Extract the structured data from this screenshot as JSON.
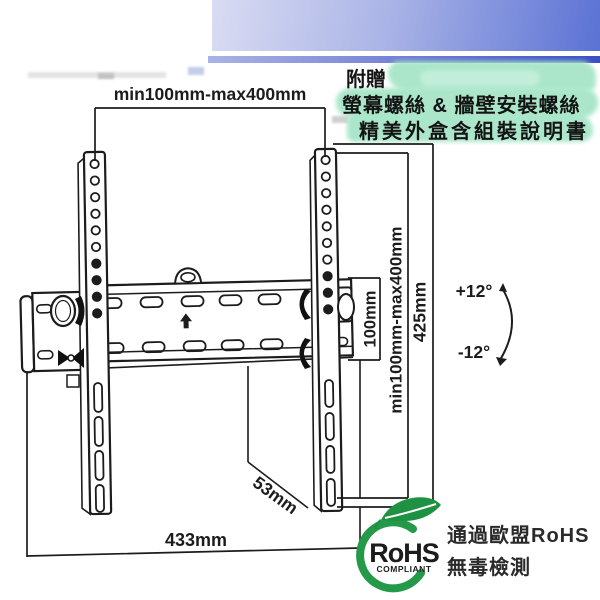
{
  "promo": {
    "line1": "附贈",
    "line2": "螢幕螺絲 & 牆壁安裝螺絲",
    "line3": "精美外盒含組裝說明書"
  },
  "dimensions": {
    "vesa_width_top": "min100mm-max400mm",
    "vesa_height_small": "100mm",
    "vesa_height_range": "min100mm-max400mm",
    "bracket_height": "425mm",
    "tilt_up": "+12°",
    "tilt_down": "-12°",
    "depth": "53mm",
    "plate_width": "433mm"
  },
  "certification": {
    "logo_text": "RoHS",
    "logo_subtext": "COMPLIANT",
    "line1": "通過歐盟RoHS",
    "line2": "無毒檢測"
  },
  "colors": {
    "header_gradient_left": "#dadcf3",
    "header_gradient_right": "#5b72d4",
    "header_line_right": "#3b4ec3",
    "highlight_green": "#a2e4c5",
    "line_art": "#1c1c1c",
    "rohs_green": "#24994a",
    "rohs_brown": "#6b3a20"
  }
}
